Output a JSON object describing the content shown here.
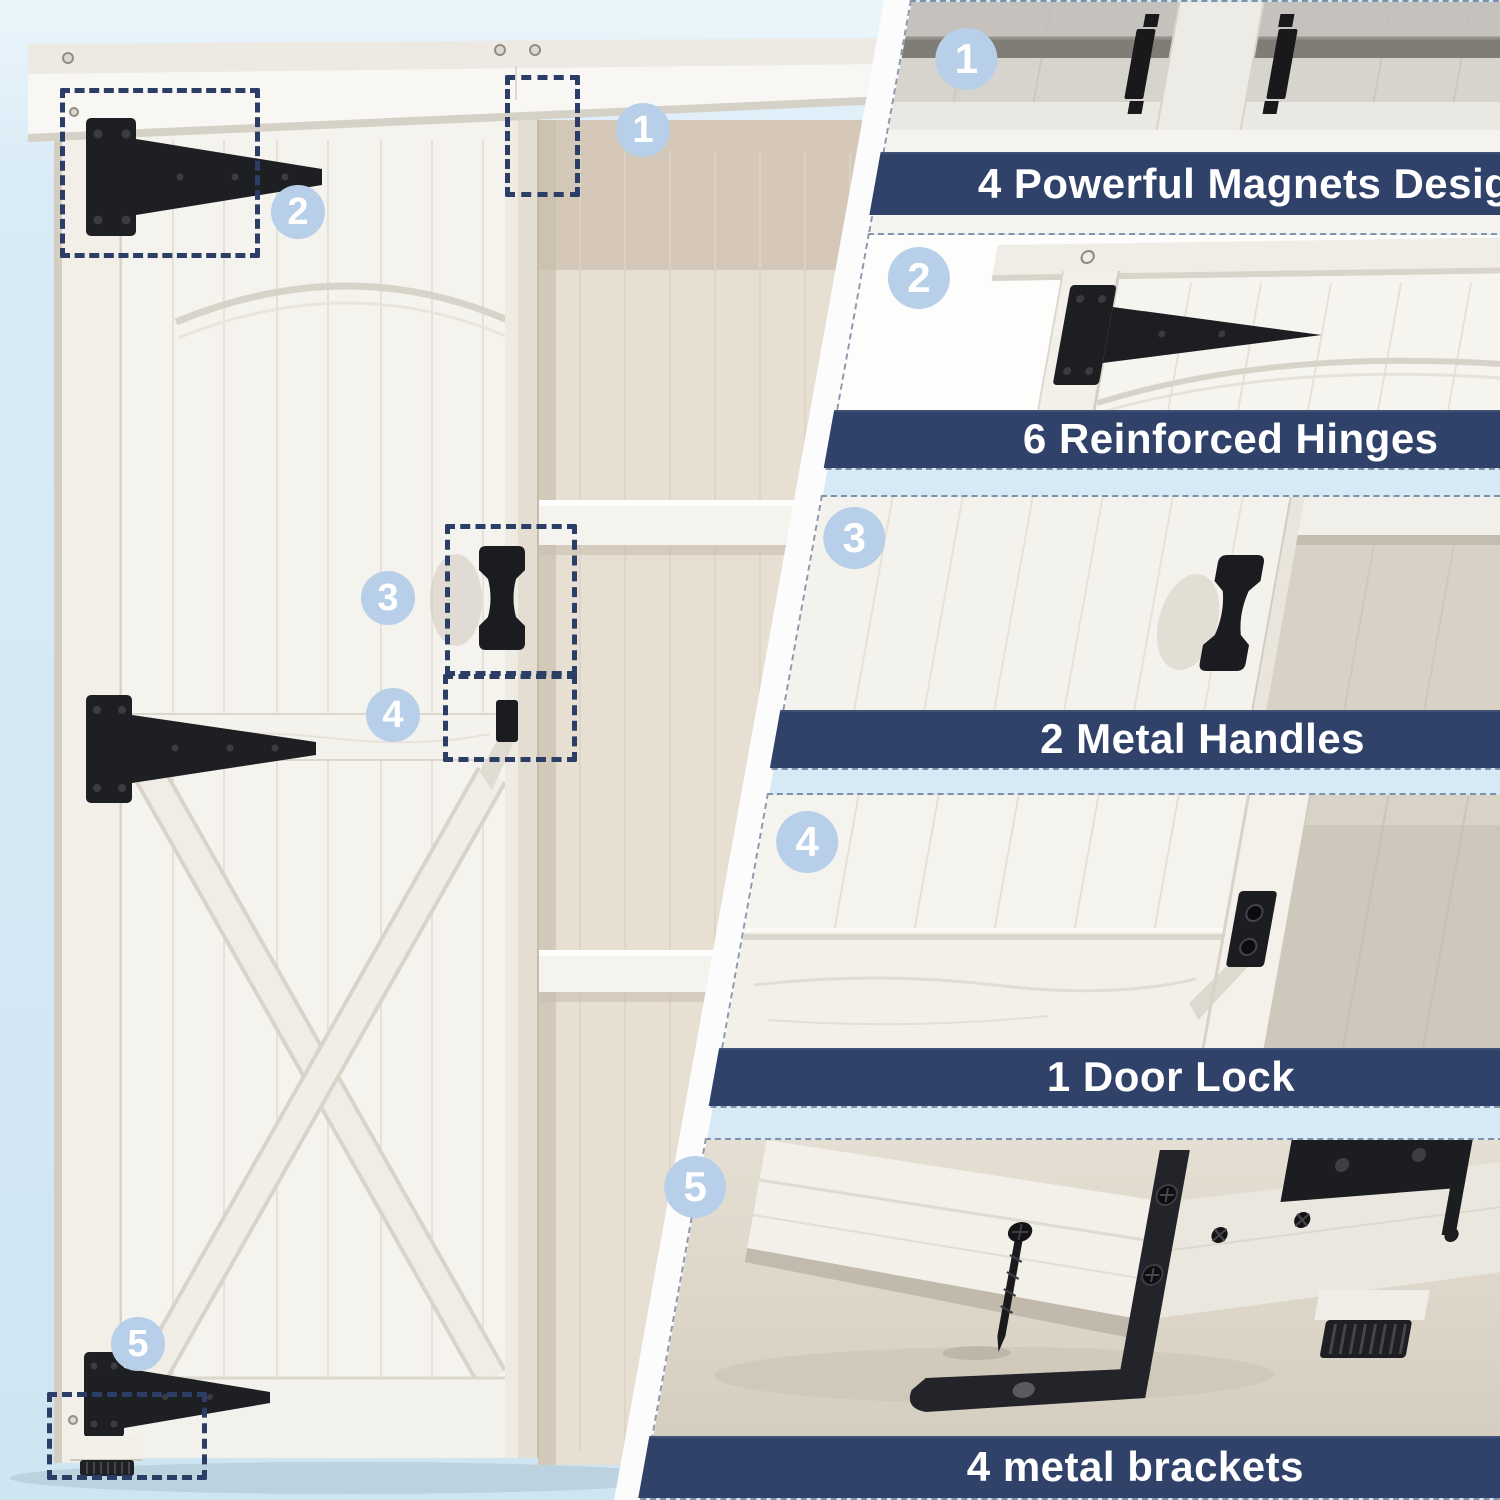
{
  "panels": [
    {
      "number": "1",
      "label": "4 Powerful Magnets Design",
      "feature": "magnets",
      "icon": "magnet-icon"
    },
    {
      "number": "2",
      "label": "6 Reinforced Hinges",
      "feature": "hinges",
      "icon": "hinge-icon"
    },
    {
      "number": "3",
      "label": "2 Metal Handles",
      "feature": "handles",
      "icon": "handle-icon"
    },
    {
      "number": "4",
      "label": "1 Door Lock",
      "feature": "door-lock",
      "icon": "lock-icon"
    },
    {
      "number": "5",
      "label": "4 metal brackets",
      "feature": "brackets",
      "icon": "bracket-icon"
    }
  ],
  "colors": {
    "page_background": "#d7e9f4",
    "banner": "#31426a",
    "banner_text": "#ffffff",
    "badge": "#b7cfe8",
    "badge_text": "#ffffff",
    "callout_dash": "#2c3e66",
    "hardware_black": "#1d1e21",
    "wood_white": "#f4f2ed",
    "interior_tan": "#d8d1c6",
    "divider_band": "#fbfcfb"
  }
}
